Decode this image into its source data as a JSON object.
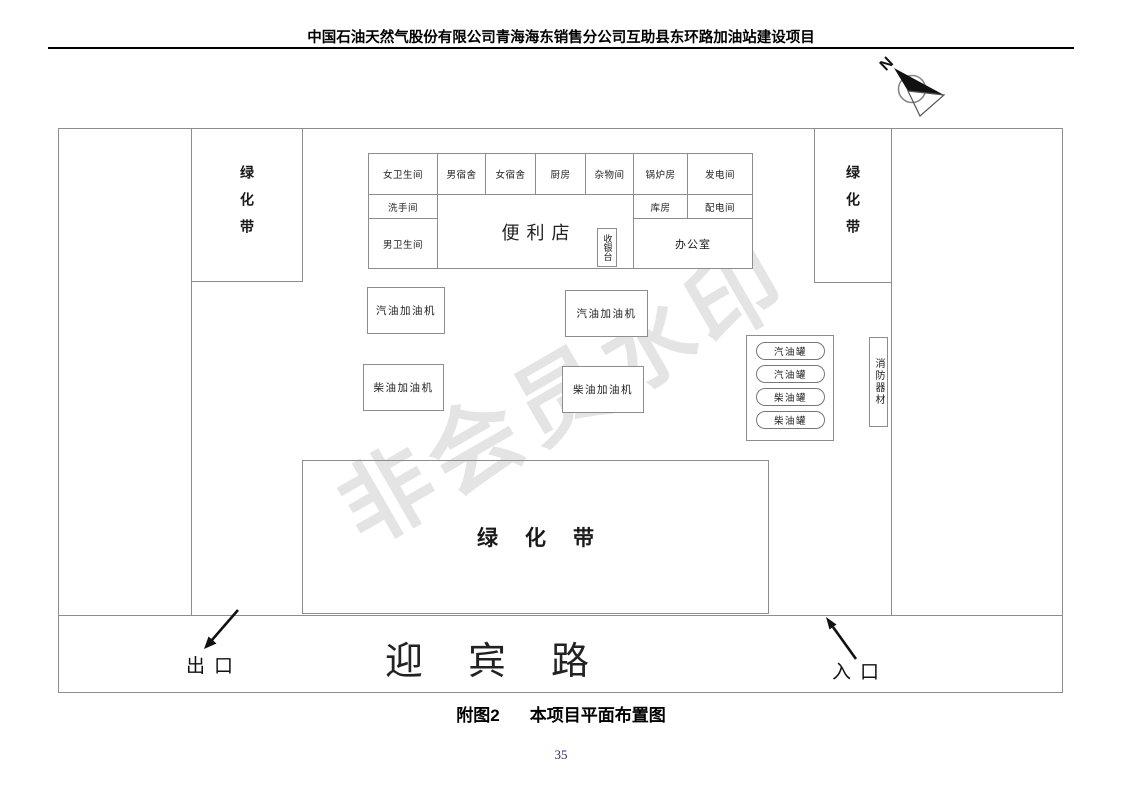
{
  "header": {
    "title": "中国石油天然气股份有限公司青海海东销售分公司互助县东环路加油站建设项目"
  },
  "compass": {
    "label": "N"
  },
  "watermark": {
    "text": "非会员水印"
  },
  "plan": {
    "green_belt_left": "绿化带",
    "green_belt_right": "绿化带",
    "green_belt_bottom": "绿化带",
    "building": {
      "row1": [
        "女卫生间",
        "男宿舍",
        "女宿舍",
        "厨房",
        "杂物间",
        "锅炉房",
        "发电间"
      ],
      "washroom": "洗手间",
      "mens_toilet": "男卫生间",
      "store": "便利店",
      "cashier": "收银台",
      "storeroom": "库房",
      "power_room": "配电间",
      "office": "办公室"
    },
    "dispensers": [
      "汽油加油机",
      "汽油加油机",
      "柴油加油机",
      "柴油加油机"
    ],
    "tanks": [
      "汽油罐",
      "汽油罐",
      "柴油罐",
      "柴油罐"
    ],
    "fire_equipment": "消防器材",
    "road": {
      "name": "迎宾路",
      "exit": "出口",
      "entrance": "入口"
    }
  },
  "caption": {
    "fig_no": "附图2",
    "title": "本项目平面布置图"
  },
  "page_number": "35",
  "colors": {
    "line": "#8d8d8d",
    "text": "#1a1a1a",
    "watermark": "#e4e4e4",
    "page_number": "#26307c"
  }
}
